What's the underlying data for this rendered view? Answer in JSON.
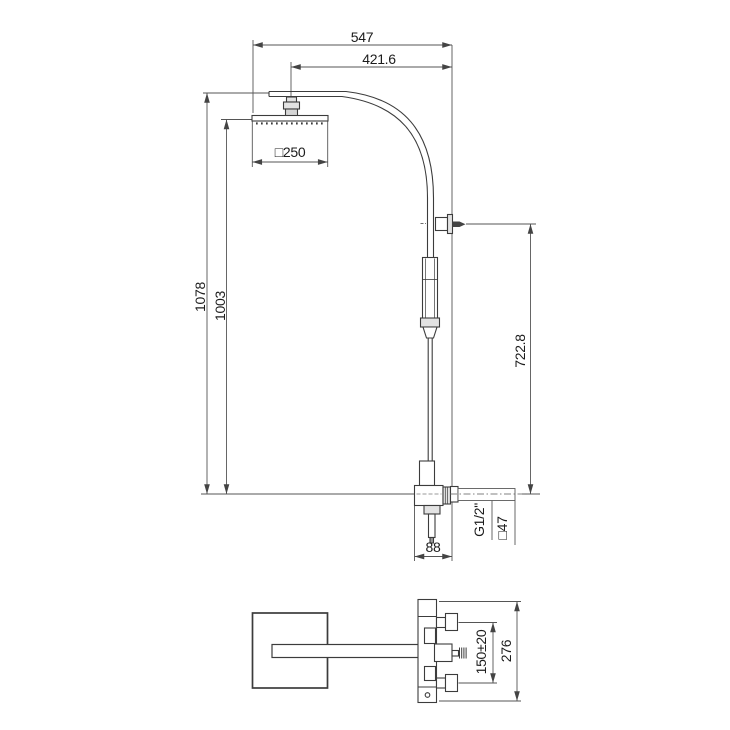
{
  "style": {
    "background": "#ffffff",
    "line_color": "#3c3c3c",
    "dim_line_color": "#555555",
    "text_color": "#1c1c1c"
  },
  "front_view": {
    "dims": {
      "overall_width": "547",
      "arm_projection": "421.6",
      "head_width": "□250",
      "height_to_arm": "1078",
      "height_to_head": "1003",
      "column_height": "722.8",
      "outlet_thread": "G1/2\"",
      "outlet_square": "□47",
      "body_depth": "88"
    }
  },
  "plan_view": {
    "dims": {
      "inlet_spacing": "150±20",
      "plate_height": "276"
    }
  }
}
